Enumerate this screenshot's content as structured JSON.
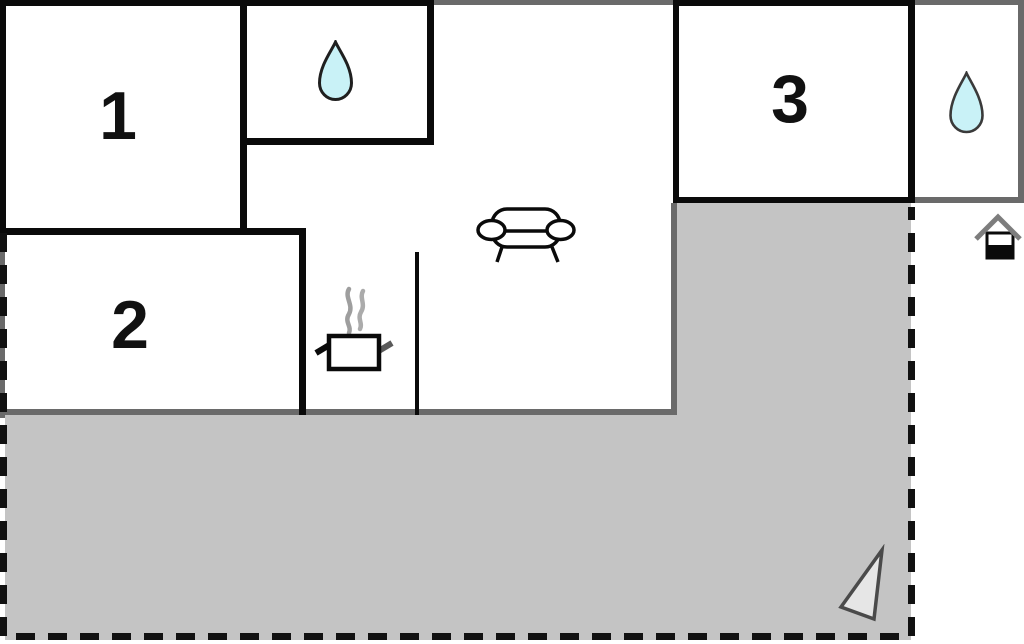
{
  "plan": {
    "type": "floor-plan",
    "rooms": [
      {
        "name": "room-1",
        "label": "1"
      },
      {
        "name": "room-2",
        "label": "2"
      },
      {
        "name": "room-3",
        "label": "3"
      }
    ],
    "areas": {
      "terrace": "gray shaded outdoor area with dashed boundary",
      "living_area": "open area with sofa",
      "kitchen": "nook with steaming cooking pot",
      "bathrooms": "two rooms marked with water drop icons"
    },
    "icons": [
      {
        "name": "water-drop-icon",
        "meaning": "bathroom",
        "count": 2
      },
      {
        "name": "sofa-icon",
        "meaning": "living room seating"
      },
      {
        "name": "cooking-pot-icon",
        "meaning": "kitchen"
      },
      {
        "name": "house-entrance-icon",
        "meaning": "entrance marker"
      },
      {
        "name": "north-triangle-icon",
        "meaning": "orientation arrow"
      }
    ],
    "colors": {
      "wall_black": "#0a0a0a",
      "wall_gray": "#6a6a6a",
      "terrace_fill": "#c4c4c4",
      "water_drop_fill": "#c9f2f7",
      "water_drop_stroke": "#1f1f1f",
      "steam_gray": "#9e9e9e",
      "north_triangle_fill": "#e6e6e6",
      "north_triangle_stroke": "#4a4a4a",
      "roof_gray": "#7d7d7d"
    }
  }
}
